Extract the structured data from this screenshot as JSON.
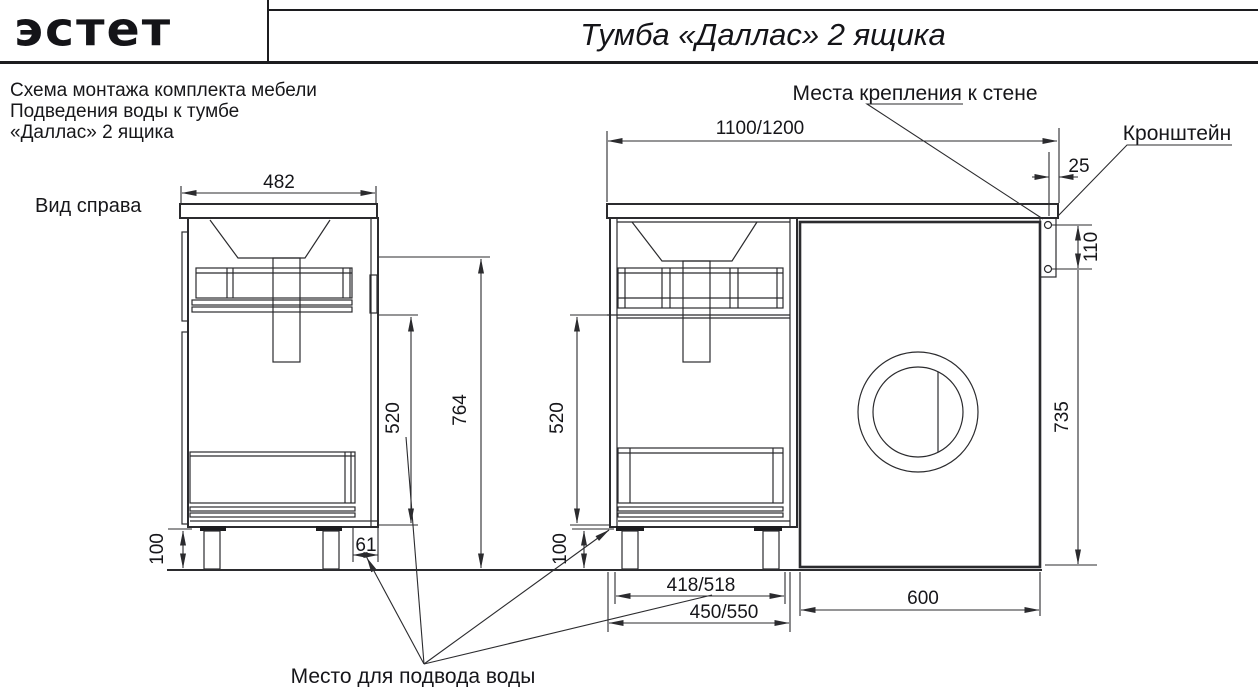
{
  "header": {
    "logo": "эстет",
    "title": "Тумба «Даллас» 2 ящика"
  },
  "description": {
    "line1": "Схема монтажа комплекта мебели",
    "line2": "Подведения воды к тумбе",
    "line3": "«Даллас» 2 ящика"
  },
  "side_view": {
    "label": "Вид справа",
    "dim_width": "482",
    "dim_drawer_height": "520",
    "dim_total_height": "764",
    "dim_legs": "100",
    "dim_water_offset": "61"
  },
  "front_view": {
    "dim_top_width": "1100/1200",
    "dim_overhang": "25",
    "dim_bracket_holes": "110",
    "dim_bracket_to_floor": "735",
    "dim_drawer_height": "520",
    "dim_legs": "100",
    "dim_water_span": "418/518",
    "dim_base_width": "450/550",
    "dim_machine_width": "600"
  },
  "callouts": {
    "wall_mount": "Места крепления к стене",
    "bracket": "Кронштейн",
    "water_supply": "Место для подвода воды"
  },
  "colors": {
    "line": "#2b2b2e",
    "text": "#16161a",
    "background": "#ffffff"
  }
}
